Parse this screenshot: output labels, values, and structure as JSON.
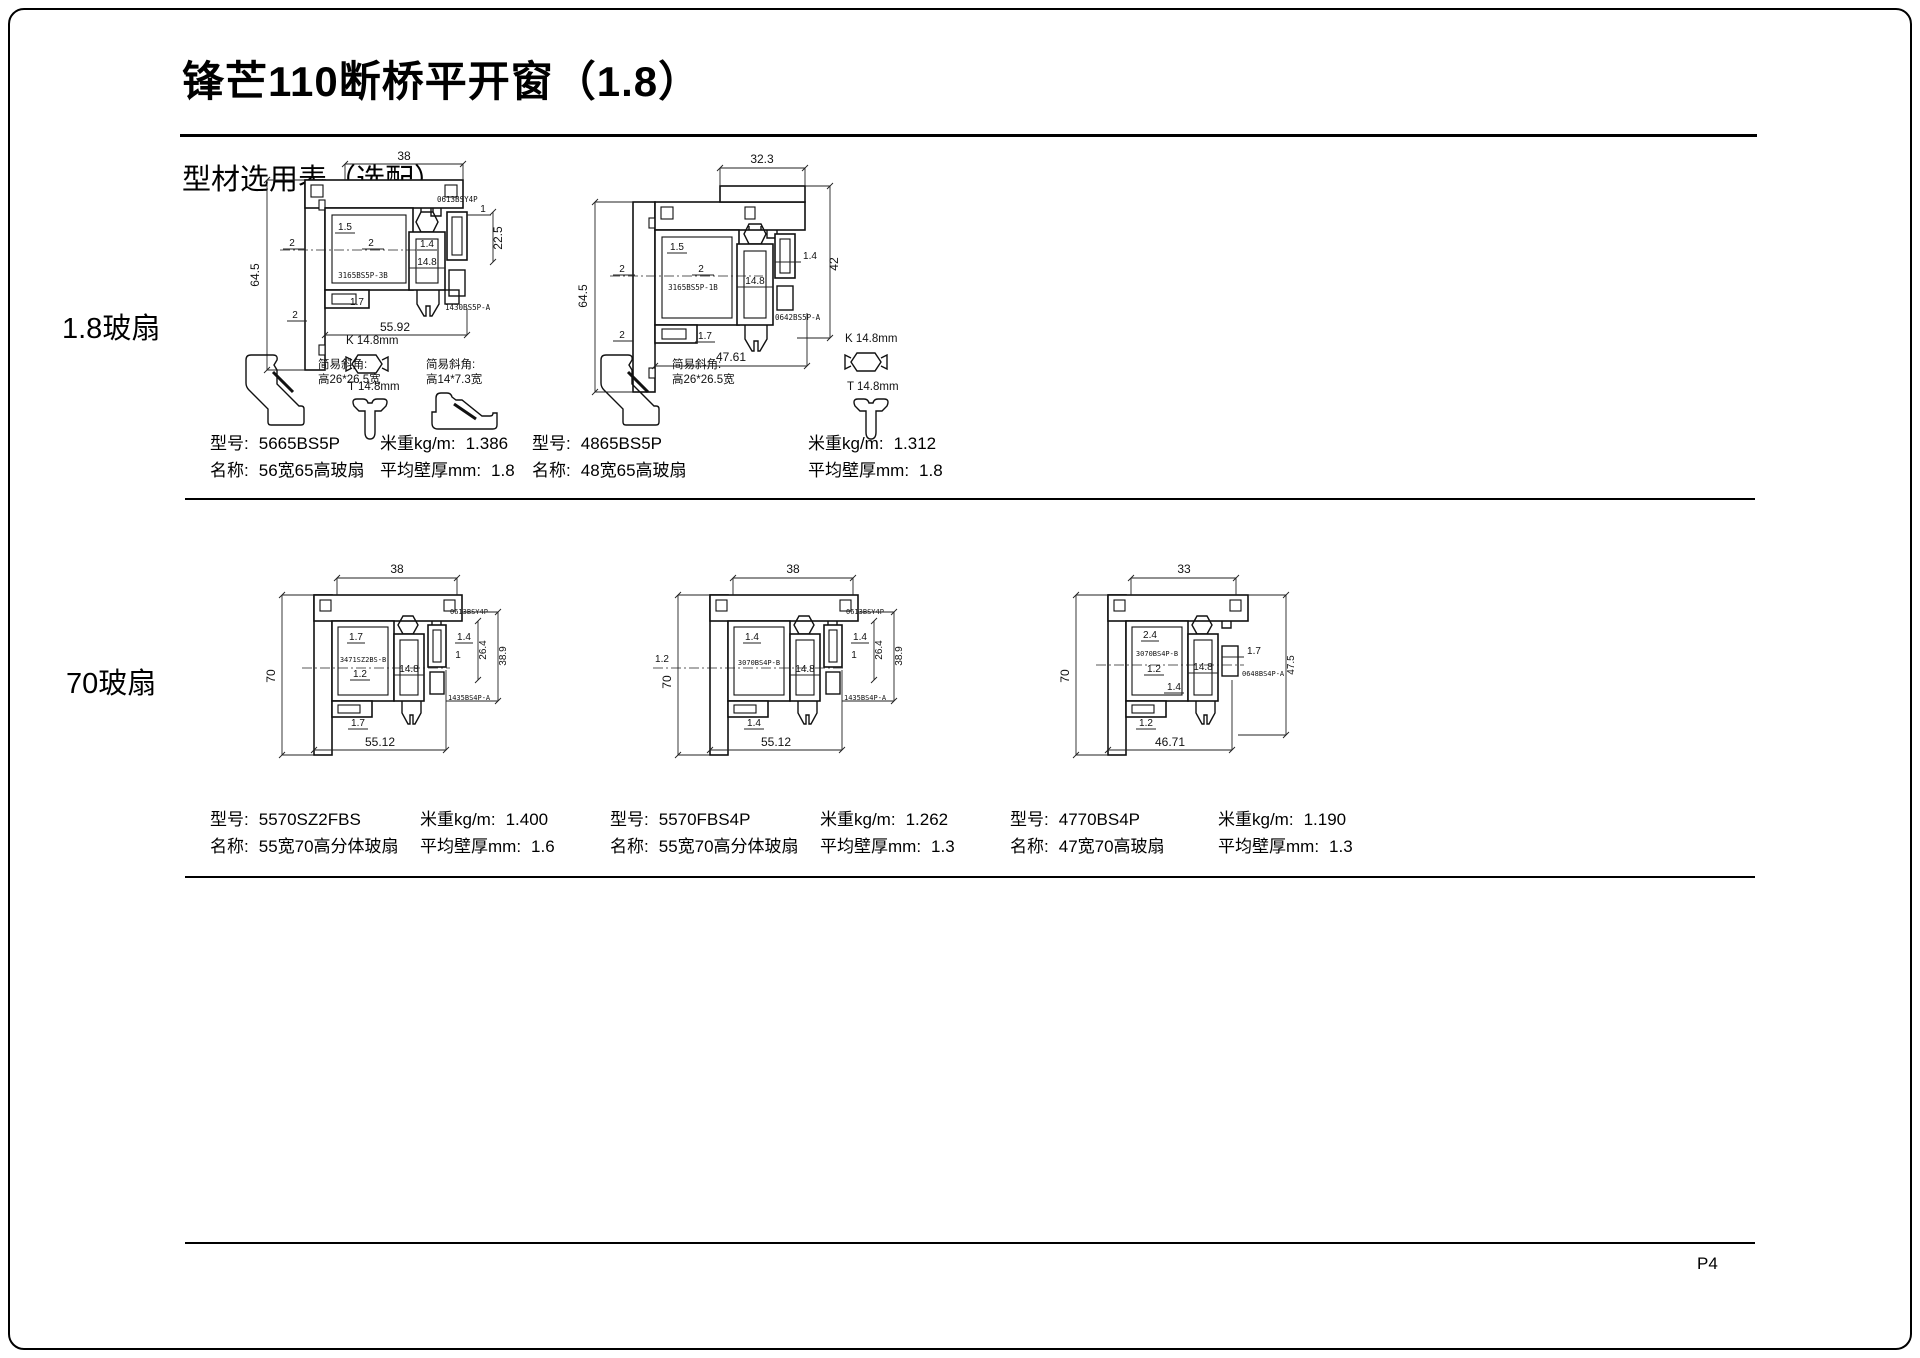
{
  "page": {
    "title": "锋芒110断桥平开窗（1.8）",
    "subtitle": "型材选用表（选配）",
    "page_number": "P4"
  },
  "rows": {
    "row1_label": "1.8玻扇",
    "row2_label": "70玻扇"
  },
  "labels": {
    "model": "型号:",
    "name": "名称:",
    "weight": "米重kg/m:",
    "thickness": "平均壁厚mm:"
  },
  "profiles": [
    {
      "model": "5665BS5P",
      "name": "56宽65高玻扇",
      "weight": "1.386",
      "thickness": "1.8"
    },
    {
      "model": "4865BS5P",
      "name": "48宽65高玻扇",
      "weight": "1.312",
      "thickness": "1.8"
    },
    {
      "model": "5570SZ2FBS",
      "name": "55宽70高分体玻扇",
      "weight": "1.400",
      "thickness": "1.6"
    },
    {
      "model": "5570FBS4P",
      "name": "55宽70高分体玻扇",
      "weight": "1.262",
      "thickness": "1.3"
    },
    {
      "model": "4770BS4P",
      "name": "47宽70高玻扇",
      "weight": "1.190",
      "thickness": "1.3"
    }
  ],
  "accessories": {
    "corner_title": "简易斜角:",
    "corner1_size": "高26*26.5宽",
    "corner2_size": "高14*7.3宽",
    "k_label": "K 14.8mm",
    "t_label": "T 14.8mm"
  },
  "diagrams": {
    "d1": {
      "dim_top": "38",
      "dim_left": "64.5",
      "dim_bottom": "55.92",
      "dim_right": "22.5",
      "w1": "1.5",
      "w2": "2",
      "w3": "2",
      "w4": "1.4",
      "w5": "14.8",
      "w6": "1.7",
      "w7": "2",
      "w8": "1",
      "part_main": "3165BS5P-3B",
      "part_bead": "0613BSY4P",
      "part_corner": "1430BS5P-A"
    },
    "d2": {
      "dim_top": "32.3",
      "dim_left": "64.5",
      "dim_right": "42",
      "dim_bottom": "47.61",
      "w1": "1.5",
      "w2": "2",
      "w3": "2",
      "w4": "1.4",
      "w5": "14.8",
      "w6": "1.7",
      "w7": "2",
      "part_main": "3165BS5P-1B",
      "part_corner": "0642BS5P-A"
    },
    "d3": {
      "dim_top": "38",
      "dim_left": "70",
      "dim_bottom": "55.12",
      "dim_r1": "38.9",
      "dim_r2": "26.4",
      "w1": "1.7",
      "w2": "1.2",
      "w3": "14.8",
      "w4": "1.4",
      "w5": "1",
      "w6": "1.7",
      "part_main": "3471SZ2BS-B",
      "part_bead": "0613BSY4P",
      "part_corner": "1435BS4P-A"
    },
    "d4": {
      "dim_top": "38",
      "dim_left": "70",
      "dim_left2": "1.2",
      "dim_bottom": "55.12",
      "dim_r1": "38.9",
      "dim_r2": "26.4",
      "w1": "1.4",
      "w2": "14.8",
      "w3": "1.4",
      "w4": "1",
      "w5": "1.4",
      "part_main": "3070BS4P-B",
      "part_bead": "0613BSY4P",
      "part_corner": "1435BS4P-A"
    },
    "d5": {
      "dim_top": "33",
      "dim_left": "70",
      "dim_right": "47.5",
      "dim_bottom": "46.71",
      "w1": "2.4",
      "w2": "1.2",
      "w3": "14.8",
      "w4": "1.4",
      "w5": "1.2",
      "w6": "1.7",
      "part_main": "3070BS4P-B",
      "part_corner": "0648BS4P-A"
    }
  }
}
